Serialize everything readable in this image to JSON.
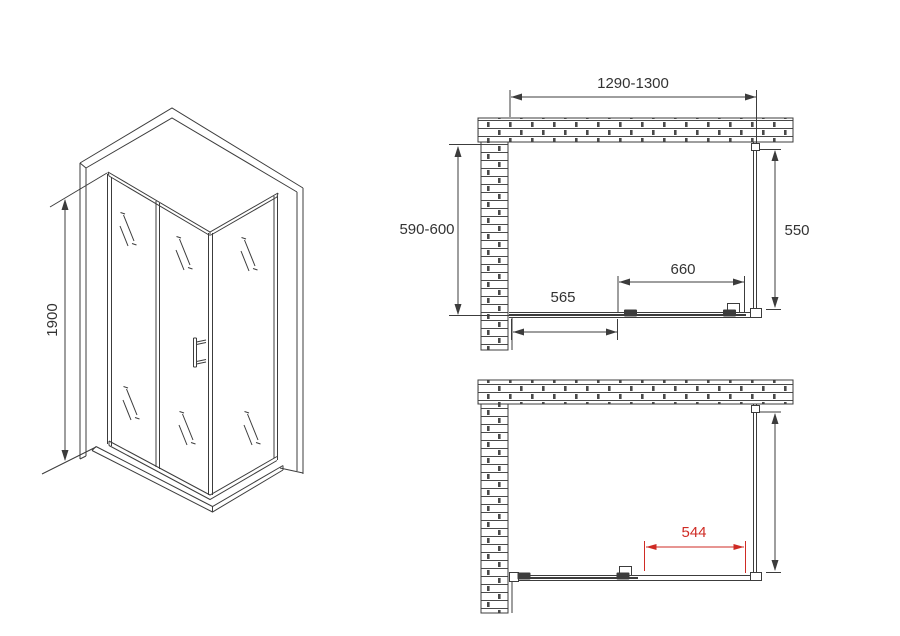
{
  "drawing": {
    "type": "shower-enclosure-dimension-diagram",
    "iso_view": {
      "height_label": "1900"
    },
    "top_plan": {
      "width_label": "1290-1300",
      "depth_label": "590-600",
      "side_panel_label": "550",
      "door_label": "660",
      "fixed_panel_label": "565"
    },
    "bottom_plan": {
      "opening_label": "544"
    },
    "colors": {
      "line": "#3c3c3c",
      "accent_red": "#cf2b24",
      "background": "#ffffff"
    }
  }
}
